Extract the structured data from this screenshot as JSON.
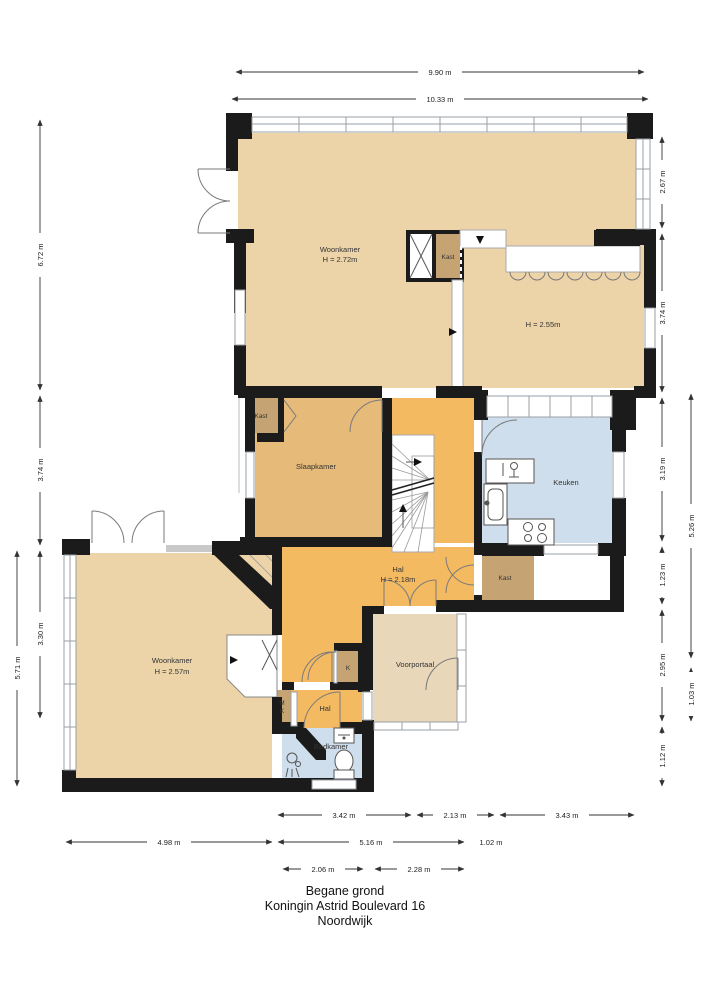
{
  "title_block": {
    "line1": "Begane grond",
    "line2": "Koningin Astrid Boulevard 16",
    "line3": "Noordwijk"
  },
  "dimensions": {
    "top": {
      "outer": "9.90 m",
      "inner": "10.33 m"
    },
    "left": {
      "d1": "6.72 m",
      "d2": "3.74 m",
      "d3": "3.30 m",
      "d4": "5.71 m"
    },
    "right": {
      "d1": "2.67 m",
      "d2": "3.74 m",
      "d3": "3.19 m",
      "d4": "1.23 m",
      "d5": "2.95 m",
      "d6": "1.12 m",
      "d7": "5.26 m",
      "d8": "1.03 m"
    },
    "bottom": {
      "d1": "3.42 m",
      "d2": "2.13 m",
      "d3": "3.43 m",
      "d4": "4.98 m",
      "d5": "5.16 m",
      "d6": "1.02 m",
      "d7": "2.06 m",
      "d8": "2.28 m"
    }
  },
  "rooms": {
    "woonkamer_top": {
      "name": "Woonkamer",
      "height": "H = 2.72m"
    },
    "kast_top": {
      "name": "Kast"
    },
    "room_right": {
      "height": "H = 2.55m"
    },
    "slaapkamer": {
      "name": "Slaapkamer"
    },
    "kast_slaapkamer": {
      "name": "Kast"
    },
    "keuken": {
      "name": "Keuken"
    },
    "hal": {
      "name": "Hal",
      "height": "H = 2.18m"
    },
    "kast_hal": {
      "name": "Kast"
    },
    "woonkamer_bottom": {
      "name": "Woonkamer",
      "height": "H = 2.57m"
    },
    "voorportaal": {
      "name": "Voorportaal"
    },
    "hal_klein": {
      "name": "Hal"
    },
    "badkamer": {
      "name": "Badkamer"
    },
    "kast_k": {
      "name": "K"
    },
    "kast_mk_m": "M",
    "kast_mk_k": "K"
  },
  "colors": {
    "wall": "#1b1b1b",
    "beige": "#ecd3a8",
    "voorportaal_beige": "#e9d7ba",
    "slaapkamer_tan": "#e6ba79",
    "hal_orange": "#f4ba62",
    "keuken_blue": "#cfdeec",
    "kast_brown": "#c5a372",
    "window_gray": "#9aa0a6"
  }
}
